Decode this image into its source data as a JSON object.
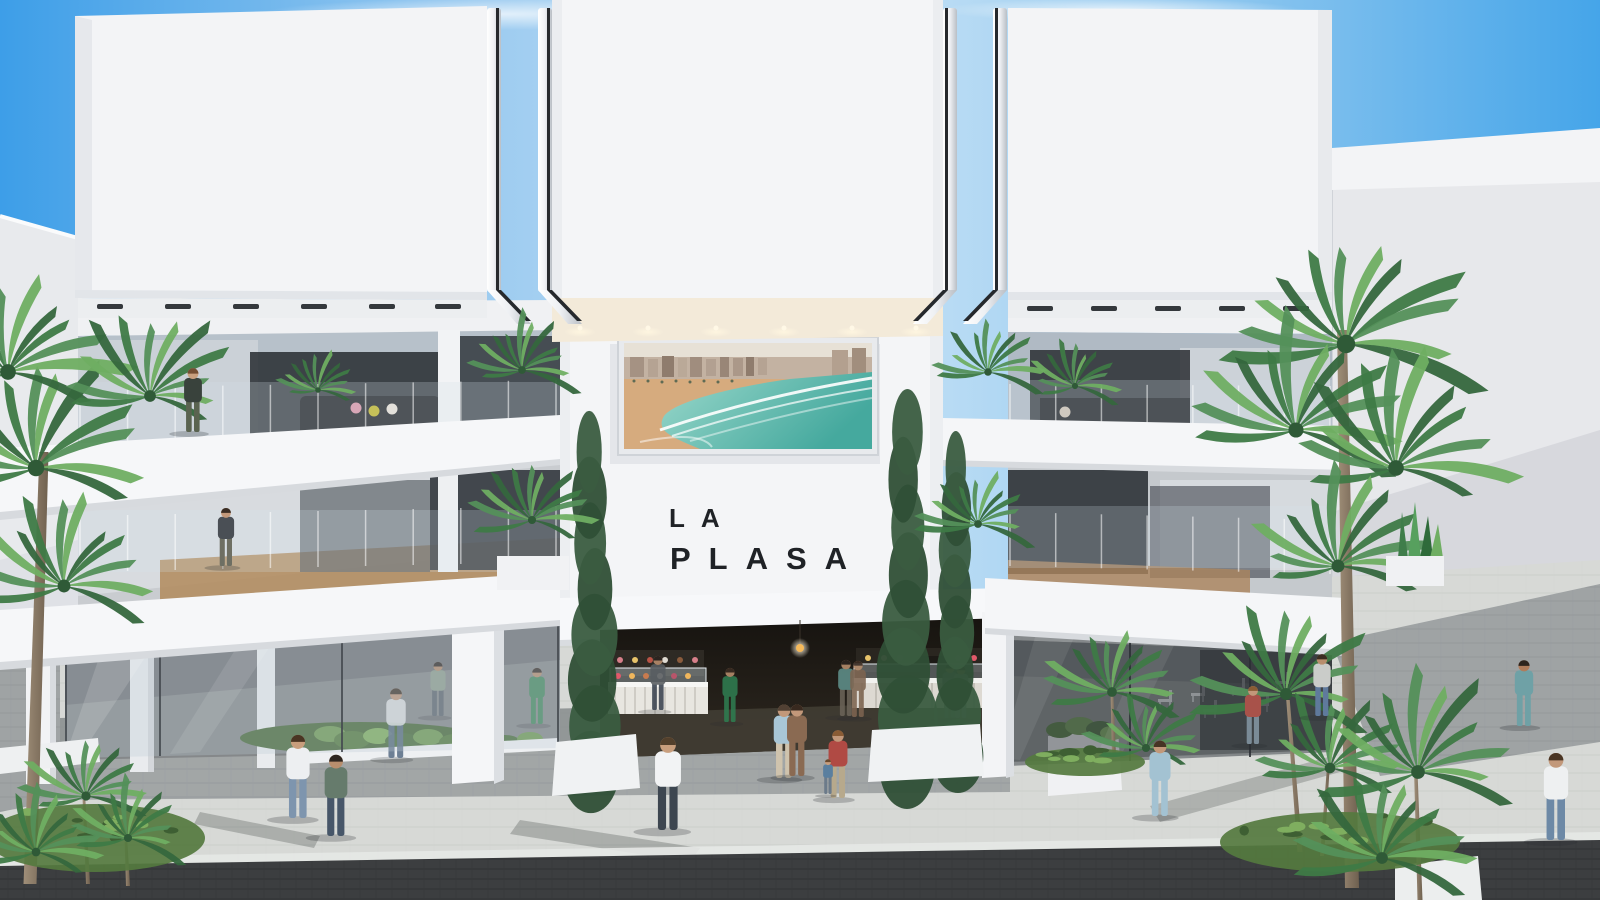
{
  "title": "LA PLASA",
  "logo": {
    "line1": "LA",
    "line2": "PLASA",
    "color": "#1f2226"
  },
  "billboard": {
    "name": "beach-aerial-photo",
    "alt": "Aerial photo of a city beachfront promenade with sand and turquoise surf"
  },
  "palette": {
    "sky_blue": "#3d9ee8",
    "facade_white": "#f3f4f6",
    "facade_shade": "#e6e8ec",
    "glass_dark": "#2b2f35",
    "glass_light": "#b7c1ca",
    "pavement_light": "#d7d9d6",
    "pavement_shade": "#9fa3a4",
    "pavement_dark": "#3c3e40",
    "palm_green": "#3e7a46",
    "palm_green_light": "#6fae62",
    "sea_teal": "#45a99e",
    "sand": "#d6ab7e",
    "warm_light": "#f5e9d4",
    "logo_color": "#1f2226"
  },
  "scene": {
    "people": [
      {
        "name": "woman-on-balcony",
        "x": 193,
        "feet": 432,
        "h": 66,
        "behind": false,
        "shirt": "#39423c",
        "pants": "#5a6350",
        "skin": "#c9a07f",
        "hair": "#744e33"
      },
      {
        "name": "woman-mid-floor",
        "x": 226,
        "feet": 566,
        "h": 60,
        "behind": false,
        "shirt": "#4a4f55",
        "pants": "#6e6f63",
        "skin": "#c2987a",
        "hair": "#3a2d24"
      },
      {
        "name": "man-white-tee-walking-left",
        "x": 298,
        "feet": 818,
        "h": 86,
        "behind": false,
        "shirt": "#edeff1",
        "pants": "#7e95ae",
        "skin": "#c89e7d",
        "hair": "#4a3523"
      },
      {
        "name": "man-green-jacket-bag",
        "x": 336,
        "feet": 836,
        "h": 84,
        "behind": false,
        "shirt": "#667b6c",
        "pants": "#475669",
        "skin": "#b88e6d",
        "hair": "#2e2620"
      },
      {
        "name": "man-at-left-counter",
        "x": 658,
        "feet": 710,
        "h": 56,
        "behind": true,
        "shirt": "#585d61",
        "pants": "#3a4350",
        "skin": "#b88e6d",
        "hair": "#2b2420"
      },
      {
        "name": "woman-green-dress",
        "x": 730,
        "feet": 722,
        "h": 56,
        "behind": true,
        "shirt": "#2f7c50",
        "pants": "#2f7c50",
        "skin": "#b88e6d",
        "hair": "#3a2b22"
      },
      {
        "name": "man-white-shirt-center",
        "x": 668,
        "feet": 830,
        "h": 96,
        "behind": false,
        "shirt": "#f2f3f4",
        "pants": "#3d4650",
        "skin": "#c89e7d",
        "hair": "#53402c"
      },
      {
        "name": "man-light-blue-couple",
        "x": 784,
        "feet": 778,
        "h": 76,
        "behind": false,
        "shirt": "#a9c6d6",
        "pants": "#cfc3ad",
        "skin": "#c2987a",
        "hair": "#514033"
      },
      {
        "name": "woman-print-dress-couple",
        "x": 797,
        "feet": 776,
        "h": 74,
        "behind": false,
        "shirt": "#8a6a52",
        "pants": "#8a6a52",
        "skin": "#c2987a",
        "hair": "#38291f"
      },
      {
        "name": "woman-with-child",
        "x": 838,
        "feet": 798,
        "h": 70,
        "behind": false,
        "shirt": "#b04a44",
        "pants": "#b7a98c",
        "skin": "#c2987a",
        "hair": "#8a5c35"
      },
      {
        "name": "small-child",
        "x": 828,
        "feet": 794,
        "h": 36,
        "behind": false,
        "shirt": "#5a7f9f",
        "pants": "#6c7b8a",
        "skin": "#c89e7d",
        "hair": "#6b4a2e"
      },
      {
        "name": "man-teal-in-hall",
        "x": 846,
        "feet": 716,
        "h": 58,
        "behind": true,
        "shirt": "#5f8f8a",
        "pants": "#6b6458",
        "skin": "#b88e6d",
        "hair": "#2b2420"
      },
      {
        "name": "woman-brown-in-hall",
        "x": 858,
        "feet": 717,
        "h": 58,
        "behind": true,
        "shirt": "#7d6450",
        "pants": "#7d6450",
        "skin": "#b88e6d",
        "hair": "#3a2b22"
      },
      {
        "name": "couple-in-hall-a",
        "x": 950,
        "feet": 718,
        "h": 56,
        "behind": true,
        "shirt": "#7a8288",
        "pants": "#4a4f55",
        "skin": "#b88e6d",
        "hair": "#2b2420"
      },
      {
        "name": "couple-in-hall-b",
        "x": 961,
        "feet": 718,
        "h": 54,
        "behind": true,
        "shirt": "#9aa3a8",
        "pants": "#5a6066",
        "skin": "#b88e6d",
        "hair": "#3a2b22"
      },
      {
        "name": "woman-blue-dress-right",
        "x": 1160,
        "feet": 816,
        "h": 78,
        "behind": false,
        "shirt": "#a3c2d2",
        "pants": "#a3c2d2",
        "skin": "#c2987a",
        "hair": "#463424"
      },
      {
        "name": "woman-and-child-right",
        "x": 1253,
        "feet": 744,
        "h": 60,
        "behind": false,
        "shirt": "#a8524a",
        "pants": "#7a8b97",
        "skin": "#c2987a",
        "hair": "#8a5c35"
      },
      {
        "name": "man-walking-away-terrace",
        "x": 1322,
        "feet": 716,
        "h": 64,
        "behind": false,
        "shirt": "#caccc9",
        "pants": "#5f7a9c",
        "skin": "#b88e6d",
        "hair": "#3b2d22"
      },
      {
        "name": "woman-teal-dress-right",
        "x": 1524,
        "feet": 726,
        "h": 68,
        "behind": false,
        "shirt": "#6fa1a6",
        "pants": "#6fa1a6",
        "skin": "#b07c5a",
        "hair": "#2e241d"
      },
      {
        "name": "man-white-tee-right",
        "x": 1556,
        "feet": 840,
        "h": 90,
        "behind": false,
        "shirt": "#eef0f1",
        "pants": "#6d89a6",
        "skin": "#c2987a",
        "hair": "#4a3523"
      },
      {
        "name": "man-behind-left-glass",
        "x": 396,
        "feet": 758,
        "h": 72,
        "behind": true,
        "shirt": "#dfe2e4",
        "pants": "#5c7088",
        "skin": "#c2987a",
        "hair": "#3b2d22"
      },
      {
        "name": "figure-behind-left-glass",
        "x": 438,
        "feet": 716,
        "h": 56,
        "behind": true,
        "shirt": "#8fa08f",
        "pants": "#5a636d",
        "skin": "#b88e6d",
        "hair": "#2b2420"
      },
      {
        "name": "woman-green-behind-glass",
        "x": 537,
        "feet": 724,
        "h": 58,
        "behind": true,
        "shirt": "#3f8a5c",
        "pants": "#3f8a5c",
        "skin": "#b88e6d",
        "hair": "#2f2721"
      }
    ],
    "palm_heads": [
      {
        "x": 36,
        "y": 468,
        "r": 118
      },
      {
        "x": 8,
        "y": 372,
        "r": 112
      },
      {
        "x": 64,
        "y": 586,
        "r": 92
      },
      {
        "x": 150,
        "y": 396,
        "r": 84
      },
      {
        "x": 318,
        "y": 390,
        "r": 40
      },
      {
        "x": 1075,
        "y": 386,
        "r": 44
      },
      {
        "x": 522,
        "y": 370,
        "r": 55
      },
      {
        "x": 532,
        "y": 520,
        "r": 58
      },
      {
        "x": 988,
        "y": 372,
        "r": 54
      },
      {
        "x": 978,
        "y": 524,
        "r": 56
      },
      {
        "x": 1346,
        "y": 344,
        "r": 132
      },
      {
        "x": 1296,
        "y": 430,
        "r": 108
      },
      {
        "x": 1396,
        "y": 468,
        "r": 112
      },
      {
        "x": 1338,
        "y": 566,
        "r": 92
      },
      {
        "x": 1286,
        "y": 694,
        "r": 86
      },
      {
        "x": 1330,
        "y": 768,
        "r": 76
      },
      {
        "x": 1418,
        "y": 772,
        "r": 98
      },
      {
        "x": 1382,
        "y": 858,
        "r": 84
      },
      {
        "x": 1112,
        "y": 692,
        "r": 70
      },
      {
        "x": 1146,
        "y": 748,
        "r": 58
      },
      {
        "x": 86,
        "y": 796,
        "r": 66
      },
      {
        "x": 128,
        "y": 838,
        "r": 58
      },
      {
        "x": 36,
        "y": 852,
        "r": 62
      }
    ],
    "trunks": [
      {
        "x1": 30,
        "y1": 884,
        "x2": 44,
        "y2": 452,
        "w": 13
      },
      {
        "x1": 1352,
        "y1": 888,
        "x2": 1342,
        "y2": 330,
        "w": 14
      },
      {
        "x1": 1300,
        "y1": 852,
        "x2": 1288,
        "y2": 700,
        "w": 5
      },
      {
        "x1": 1322,
        "y1": 856,
        "x2": 1328,
        "y2": 772,
        "w": 4
      },
      {
        "x1": 88,
        "y1": 884,
        "x2": 84,
        "y2": 800,
        "w": 4
      },
      {
        "x1": 128,
        "y1": 886,
        "x2": 126,
        "y2": 842,
        "w": 4
      },
      {
        "x1": 1420,
        "y1": 900,
        "x2": 1416,
        "y2": 778,
        "w": 5
      },
      {
        "x1": 1114,
        "y1": 756,
        "x2": 1112,
        "y2": 696,
        "w": 4
      }
    ],
    "cypresses": [
      {
        "x": 592,
        "top": 452,
        "base": 772,
        "w": 46
      },
      {
        "x": 906,
        "top": 432,
        "base": 766,
        "w": 50
      },
      {
        "x": 956,
        "top": 468,
        "base": 756,
        "w": 40
      }
    ],
    "grass_patches": [
      {
        "x": 95,
        "y": 838,
        "rx": 110,
        "ry": 34
      },
      {
        "x": 1340,
        "y": 842,
        "rx": 120,
        "ry": 30
      },
      {
        "x": 1085,
        "y": 762,
        "rx": 60,
        "ry": 14
      }
    ],
    "downlights": [
      580,
      648,
      716,
      784,
      852,
      916
    ],
    "track_lights_left": [
      110,
      178,
      246,
      314,
      382,
      448
    ],
    "track_lights_right": [
      1040,
      1104,
      1168,
      1232,
      1296
    ],
    "terrace_chairs": [
      {
        "x": 1165,
        "y": 702
      },
      {
        "x": 1198,
        "y": 696
      },
      {
        "x": 1238,
        "y": 690
      },
      {
        "x": 1282,
        "y": 684
      },
      {
        "x": 1210,
        "y": 712
      },
      {
        "x": 1262,
        "y": 706
      }
    ],
    "cushions": [
      {
        "x": 356,
        "y": 408,
        "c": "#d8a7b7"
      },
      {
        "x": 374,
        "y": 411,
        "c": "#c6c159"
      },
      {
        "x": 392,
        "y": 409,
        "c": "#e3e0da"
      },
      {
        "x": 1065,
        "y": 412,
        "c": "#cfc9c0"
      }
    ],
    "railings": [
      {
        "x1": 80,
        "y1": 388,
        "x2": 556,
        "y2": 380,
        "h": 58,
        "n": 11
      },
      {
        "x1": 1010,
        "y1": 384,
        "x2": 1330,
        "y2": 386,
        "h": 56,
        "n": 8
      },
      {
        "x1": 80,
        "y1": 516,
        "x2": 556,
        "y2": 506,
        "h": 56,
        "n": 11
      },
      {
        "x1": 1010,
        "y1": 512,
        "x2": 1330,
        "y2": 520,
        "h": 54,
        "n": 8
      }
    ]
  }
}
